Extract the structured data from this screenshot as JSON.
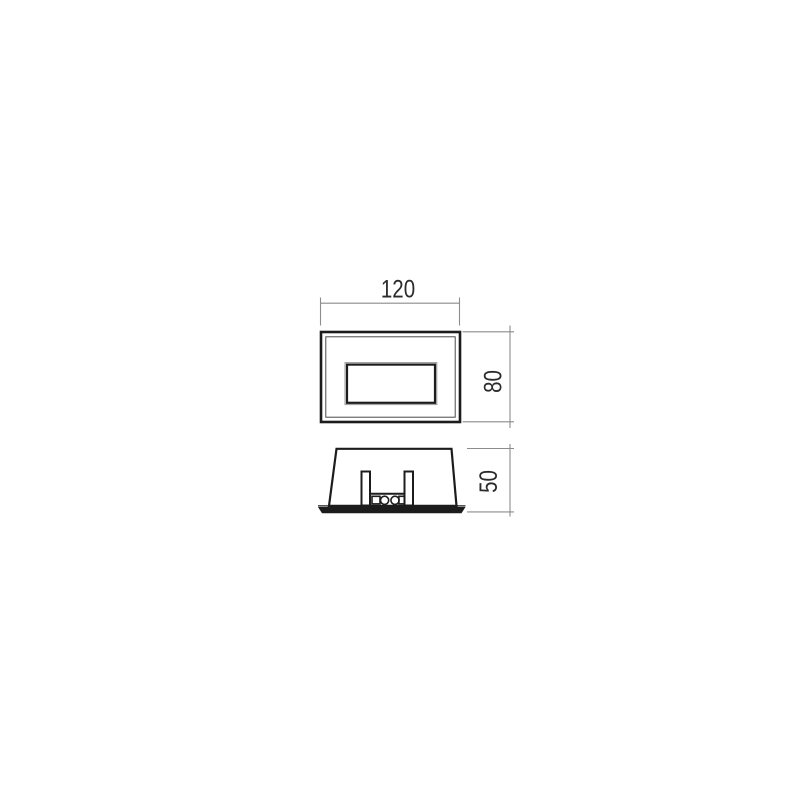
{
  "drawing": {
    "type_label": "technical-dimension-drawing",
    "dimensions": {
      "width_label": "120",
      "height_label": "80",
      "depth_label": "50"
    },
    "colors": {
      "background": "#ffffff",
      "object_line": "#1c1c1c",
      "thin_line": "#4a4a4a",
      "faint_line": "#9a9a9a",
      "dimension_line": "#8c8c8c",
      "text": "#2b2b2b",
      "fill": "#ffffff"
    }
  }
}
